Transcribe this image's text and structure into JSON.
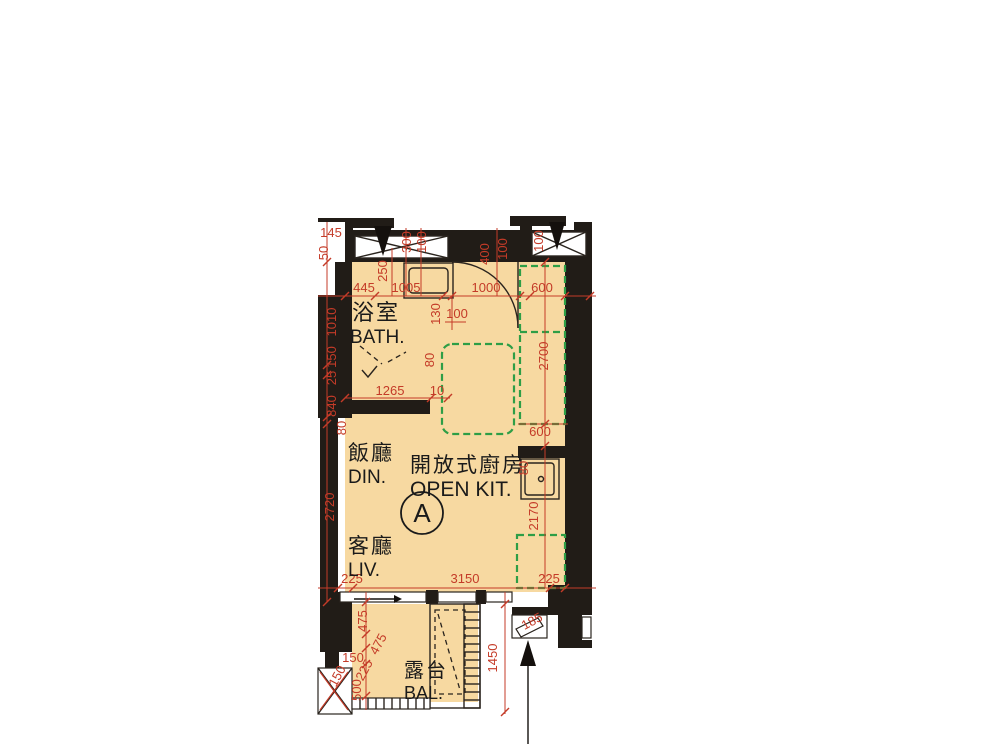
{
  "unit_label": "A",
  "rooms": {
    "bath": {
      "zh": "浴室",
      "en": "BATH."
    },
    "dining": {
      "zh": "飯廳",
      "en": "DIN."
    },
    "open_kitchen": {
      "zh": "開放式廚房",
      "en": "OPEN KIT."
    },
    "living": {
      "zh": "客廳",
      "en": "LIV."
    },
    "balcony": {
      "zh": "露台",
      "en": "BAL."
    }
  },
  "dims": {
    "d145": "145",
    "d50": "50",
    "d300": "300",
    "d100_top": "100",
    "d250": "250",
    "d445": "445",
    "d1005": "1005",
    "d1000": "1000",
    "d600_top": "600",
    "d400": "400",
    "d100_entry": "100",
    "d100_win": "100",
    "d1010": "1010",
    "d150_left": "150",
    "d25": "25",
    "d840": "840",
    "d80_left": "80",
    "d130": "130",
    "d100_bath": "100",
    "d1265": "1265",
    "d10": "10",
    "d80_bathdoor": "80",
    "d2700": "2700",
    "d600_counter": "600",
    "d80_sink": "80",
    "d2170": "2170",
    "d2720": "2720",
    "d225_left": "225",
    "d3150": "3150",
    "d225_right": "225",
    "d475_a": "475",
    "d475_b": "475",
    "d150_bal": "150",
    "d225_bal": "225",
    "d500": "500",
    "d150_corner": "150",
    "d1450": "1450",
    "d185": "185"
  },
  "colors": {
    "bg": "#ffffff",
    "floor": "#f7d9a1",
    "wall": "#211c17",
    "dim": "#c43b28",
    "counter_dash": "#2e9e46",
    "label": "#1a1a1a"
  }
}
